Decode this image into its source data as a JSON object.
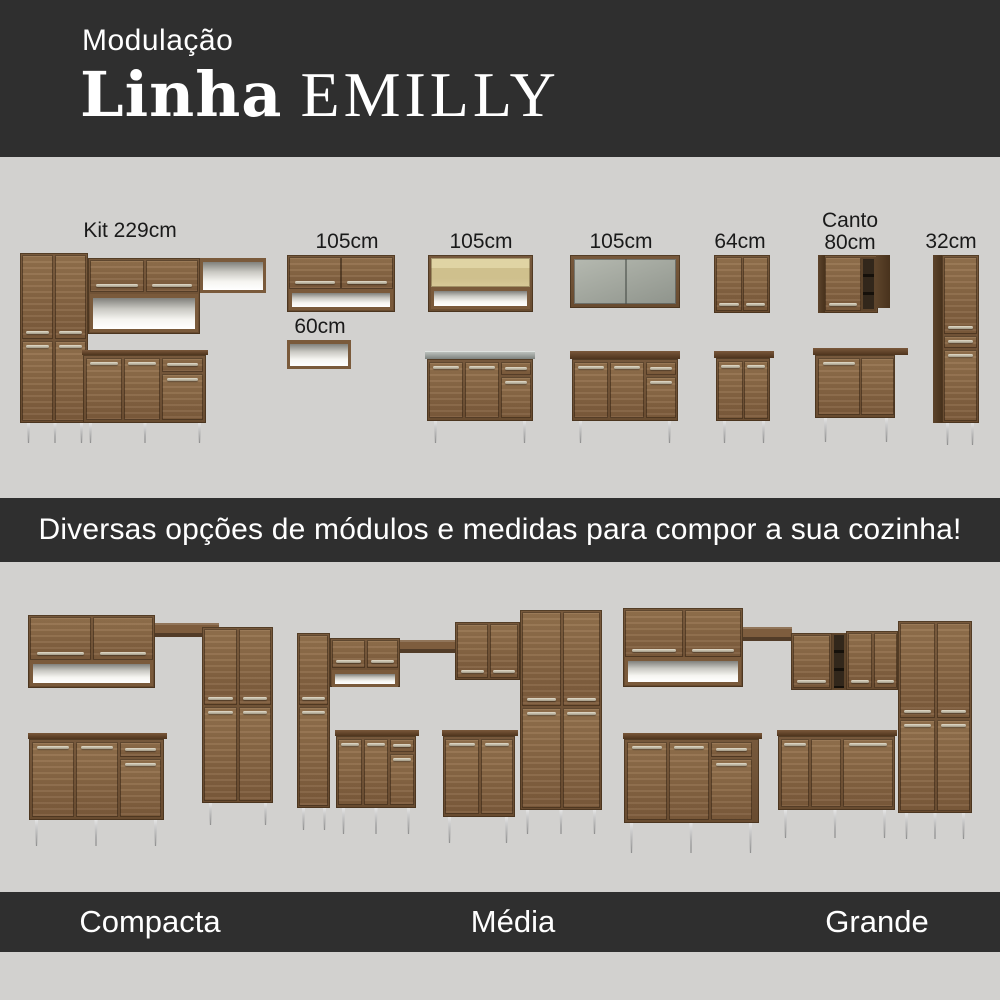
{
  "header": {
    "kicker": "Modulação",
    "title_line": "Linha",
    "title_brand": "EMILLY"
  },
  "modules_section": {
    "labels": {
      "kit": "Kit 229cm",
      "wall_105_a": "105cm",
      "niche_60": "60cm",
      "wall_105_b": "105cm",
      "wall_105_c": "105cm",
      "wall_64": "64cm",
      "canto_line1": "Canto",
      "canto_line2": "80cm",
      "tall_32": "32cm"
    }
  },
  "banner": {
    "text": "Diversas opções de módulos e medidas para compor a sua cozinha!"
  },
  "kitchens_section": {
    "labels": {
      "compacta": "Compacta",
      "media": "Média",
      "grande": "Grande"
    }
  },
  "colors": {
    "band_dark": "#2f2f2f",
    "background_light": "#d2d1cf",
    "wood_door": "#8a6746",
    "wood_carcass": "#6f5237",
    "wood_dark_panel": "#543d26",
    "handle_metal": "#cdc6b4",
    "leg_metal": "#c9c9c9",
    "text_on_dark": "#ffffff",
    "text_on_light": "#1a1a1a"
  }
}
